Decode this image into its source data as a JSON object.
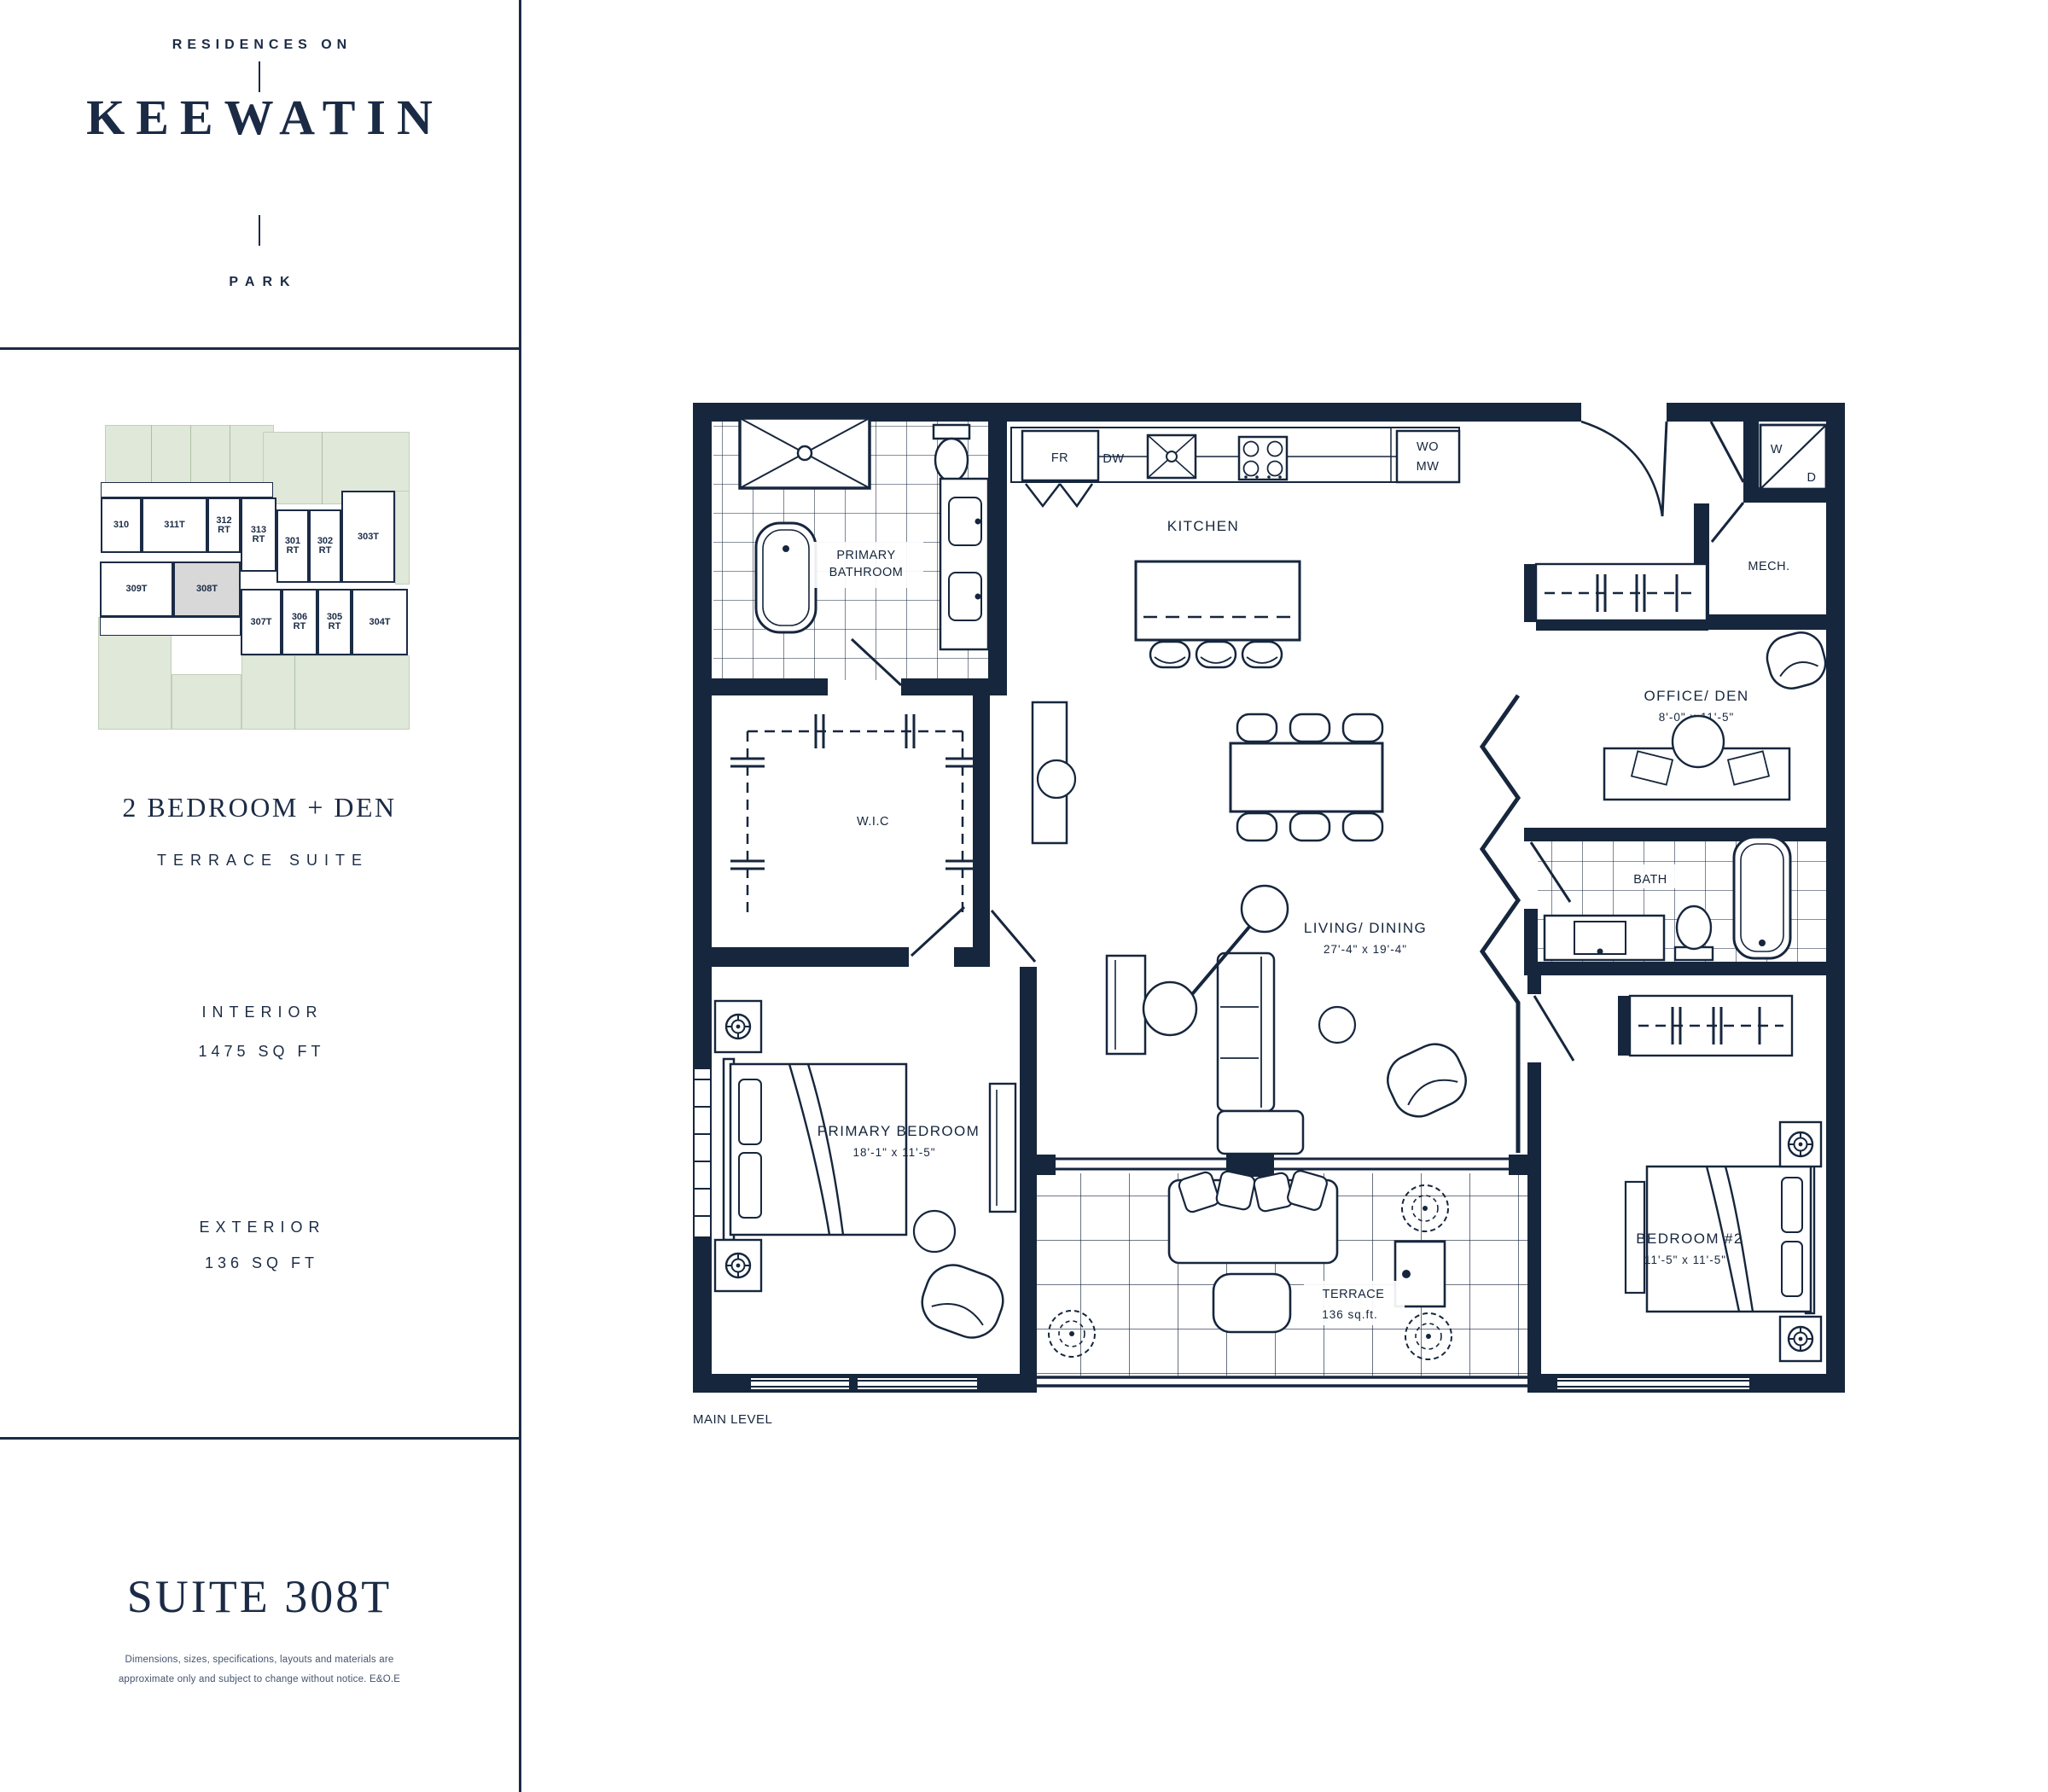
{
  "brand": {
    "top": "RESIDENCES ON",
    "name": "KEEWATIN",
    "bottom": "PARK"
  },
  "keyplan": {
    "suites": [
      {
        "num": "310",
        "suffix": ""
      },
      {
        "num": "311T",
        "suffix": ""
      },
      {
        "num": "312",
        "suffix": "RT"
      },
      {
        "num": "313",
        "suffix": "RT"
      },
      {
        "num": "301",
        "suffix": "RT"
      },
      {
        "num": "302",
        "suffix": "RT"
      },
      {
        "num": "303T",
        "suffix": ""
      },
      {
        "num": "309T",
        "suffix": ""
      },
      {
        "num": "308T",
        "suffix": ""
      },
      {
        "num": "307T",
        "suffix": ""
      },
      {
        "num": "306",
        "suffix": "RT"
      },
      {
        "num": "305",
        "suffix": "RT"
      },
      {
        "num": "304T",
        "suffix": ""
      }
    ],
    "highlighted_suite": "308T",
    "colors": {
      "green": "#dfe8d9",
      "highlight_gray": "#d8d8d8",
      "navy": "#1b2b45"
    }
  },
  "suite": {
    "type_line1": "2 BEDROOM + DEN",
    "type_line2": "TERRACE SUITE",
    "interior_label": "INTERIOR",
    "interior_value": "1475 SQ FT",
    "exterior_label": "EXTERIOR",
    "exterior_value": "136 SQ FT",
    "title": "SUITE 308T",
    "disclaimer_line1": "Dimensions, sizes, specifications, layouts and materials are",
    "disclaimer_line2": "approximate only and subject to change without notice. E&O.E"
  },
  "plan": {
    "level": "MAIN LEVEL",
    "kitchen": {
      "label": "KITCHEN",
      "fr": "FR",
      "dw": "DW",
      "wo": "WO",
      "mw": "MW"
    },
    "laundry": {
      "w": "W",
      "d": "D"
    },
    "mech": "MECH.",
    "wic": "W.I.C",
    "primary_bath": {
      "line1": "PRIMARY",
      "line2": "BATHROOM"
    },
    "bath": "BATH",
    "office": {
      "label": "OFFICE/ DEN",
      "dims": "8'-0\" x 11'-5\""
    },
    "living": {
      "label": "LIVING/ DINING",
      "dims": "27'-4\" x 19'-4\""
    },
    "primary_bedroom": {
      "label": "PRIMARY BEDROOM",
      "dims": "18'-1\" x 11'-5\""
    },
    "bedroom2": {
      "label": "BEDROOM #2",
      "dims": "11'-5\" x 11'-5\""
    },
    "terrace": {
      "label": "TERRACE",
      "dims": "136 sq.ft."
    },
    "wall_color": "#16263d"
  }
}
